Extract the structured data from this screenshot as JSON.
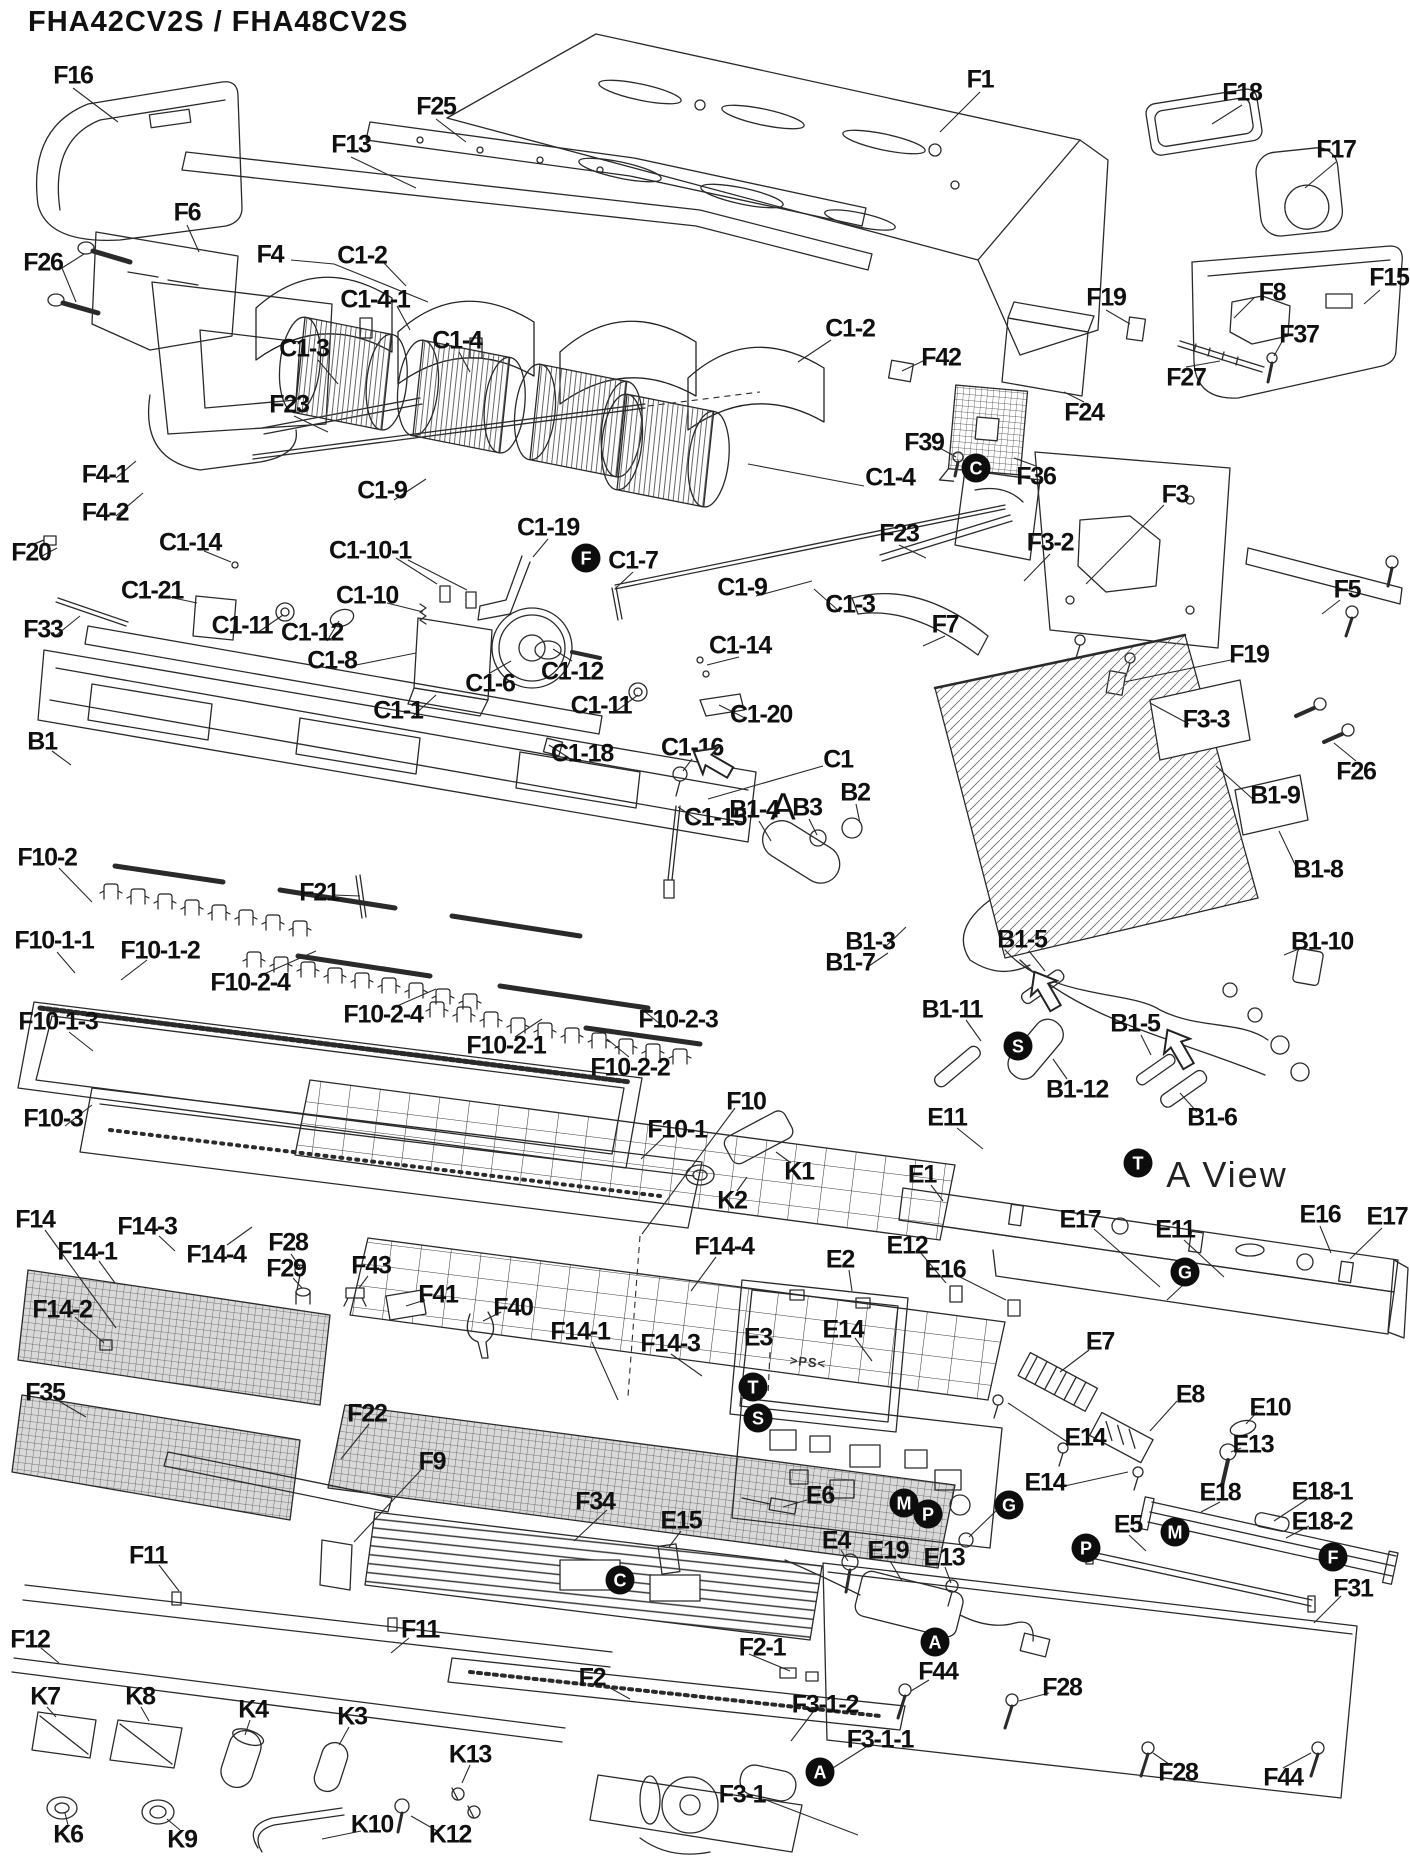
{
  "title": "FHA42CV2S / FHA48CV2S",
  "diagram": {
    "type": "exploded-parts-diagram",
    "view_label": "A View",
    "section_pointer": {
      "t": "A",
      "x": 783,
      "y": 808
    },
    "molding_mark": {
      "t": ">PS<",
      "x": 808,
      "y": 1362
    },
    "ink_color": "#1a1a1a",
    "background_color": "#ffffff",
    "part_labels": [
      {
        "t": "F16",
        "x": 73,
        "y": 76
      },
      {
        "t": "F1",
        "x": 980,
        "y": 80
      },
      {
        "t": "F18",
        "x": 1242,
        "y": 93
      },
      {
        "t": "F17",
        "x": 1336,
        "y": 150
      },
      {
        "t": "F25",
        "x": 436,
        "y": 107
      },
      {
        "t": "F13",
        "x": 351,
        "y": 145
      },
      {
        "t": "F6",
        "x": 187,
        "y": 213
      },
      {
        "t": "F26",
        "x": 43,
        "y": 263
      },
      {
        "t": "F4",
        "x": 270,
        "y": 255
      },
      {
        "t": "C1-2",
        "x": 362,
        "y": 256
      },
      {
        "t": "C1-4-1",
        "x": 375,
        "y": 300
      },
      {
        "t": "F19",
        "x": 1106,
        "y": 298
      },
      {
        "t": "F8",
        "x": 1272,
        "y": 293
      },
      {
        "t": "F15",
        "x": 1389,
        "y": 278
      },
      {
        "t": "F37",
        "x": 1299,
        "y": 335
      },
      {
        "t": "C1-3",
        "x": 304,
        "y": 349
      },
      {
        "t": "C1-4",
        "x": 457,
        "y": 341
      },
      {
        "t": "C1-2",
        "x": 850,
        "y": 329
      },
      {
        "t": "F42",
        "x": 941,
        "y": 358
      },
      {
        "t": "F27",
        "x": 1186,
        "y": 378
      },
      {
        "t": "F24",
        "x": 1084,
        "y": 413
      },
      {
        "t": "F23",
        "x": 289,
        "y": 405
      },
      {
        "t": "F39",
        "x": 924,
        "y": 443
      },
      {
        "t": "F36",
        "x": 1036,
        "y": 477
      },
      {
        "t": "C1-4",
        "x": 890,
        "y": 478
      },
      {
        "t": "F3",
        "x": 1175,
        "y": 495
      },
      {
        "t": "F4-1",
        "x": 105,
        "y": 475
      },
      {
        "t": "F4-2",
        "x": 105,
        "y": 513
      },
      {
        "t": "F20",
        "x": 31,
        "y": 553
      },
      {
        "t": "C1-9",
        "x": 382,
        "y": 491
      },
      {
        "t": "C1-19",
        "x": 548,
        "y": 528
      },
      {
        "t": "C1-14",
        "x": 190,
        "y": 543
      },
      {
        "t": "C1-10-1",
        "x": 370,
        "y": 551
      },
      {
        "t": "C1-7",
        "x": 633,
        "y": 561
      },
      {
        "t": "C1-9",
        "x": 742,
        "y": 588
      },
      {
        "t": "C1-3",
        "x": 850,
        "y": 605
      },
      {
        "t": "F23",
        "x": 899,
        "y": 534
      },
      {
        "t": "F7",
        "x": 945,
        "y": 625
      },
      {
        "t": "F3-2",
        "x": 1050,
        "y": 543
      },
      {
        "t": "F5",
        "x": 1347,
        "y": 590
      },
      {
        "t": "C1-21",
        "x": 152,
        "y": 591
      },
      {
        "t": "C1-10",
        "x": 367,
        "y": 596
      },
      {
        "t": "C1-11",
        "x": 242,
        "y": 626
      },
      {
        "t": "C1-12",
        "x": 312,
        "y": 633
      },
      {
        "t": "F33",
        "x": 43,
        "y": 630
      },
      {
        "t": "C1-8",
        "x": 332,
        "y": 661
      },
      {
        "t": "C1-6",
        "x": 490,
        "y": 684
      },
      {
        "t": "C1-12",
        "x": 572,
        "y": 672
      },
      {
        "t": "C1-14",
        "x": 740,
        "y": 646
      },
      {
        "t": "C1-11",
        "x": 601,
        "y": 706
      },
      {
        "t": "C1-20",
        "x": 761,
        "y": 715
      },
      {
        "t": "F19",
        "x": 1249,
        "y": 655
      },
      {
        "t": "F3-3",
        "x": 1206,
        "y": 720
      },
      {
        "t": "F26",
        "x": 1356,
        "y": 772
      },
      {
        "t": "C1-1",
        "x": 398,
        "y": 711
      },
      {
        "t": "B1",
        "x": 42,
        "y": 742
      },
      {
        "t": "C1-18",
        "x": 582,
        "y": 754
      },
      {
        "t": "C1-16",
        "x": 692,
        "y": 748
      },
      {
        "t": "C1",
        "x": 838,
        "y": 760
      },
      {
        "t": "C1-15",
        "x": 715,
        "y": 818
      },
      {
        "t": "B3",
        "x": 807,
        "y": 808
      },
      {
        "t": "B2",
        "x": 855,
        "y": 793
      },
      {
        "t": "B1-4",
        "x": 754,
        "y": 810
      },
      {
        "t": "B1-9",
        "x": 1275,
        "y": 796
      },
      {
        "t": "B1-8",
        "x": 1318,
        "y": 870
      },
      {
        "t": "B1-3",
        "x": 870,
        "y": 942
      },
      {
        "t": "B1-7",
        "x": 850,
        "y": 963
      },
      {
        "t": "B1-5",
        "x": 1022,
        "y": 940
      },
      {
        "t": "B1-10",
        "x": 1322,
        "y": 942
      },
      {
        "t": "B1-11",
        "x": 952,
        "y": 1010
      },
      {
        "t": "B1-12",
        "x": 1077,
        "y": 1090
      },
      {
        "t": "B1-5",
        "x": 1135,
        "y": 1024
      },
      {
        "t": "B1-6",
        "x": 1212,
        "y": 1118
      },
      {
        "t": "E11",
        "x": 947,
        "y": 1118
      },
      {
        "t": "E1",
        "x": 922,
        "y": 1175
      },
      {
        "t": "E12",
        "x": 907,
        "y": 1246
      },
      {
        "t": "E16",
        "x": 1320,
        "y": 1215
      },
      {
        "t": "E17",
        "x": 1387,
        "y": 1217
      },
      {
        "t": "F10-2",
        "x": 47,
        "y": 858
      },
      {
        "t": "F21",
        "x": 319,
        "y": 893
      },
      {
        "t": "F10-1-1",
        "x": 54,
        "y": 941
      },
      {
        "t": "F10-1-2",
        "x": 160,
        "y": 951
      },
      {
        "t": "F10-2-4",
        "x": 250,
        "y": 983
      },
      {
        "t": "F10-1-3",
        "x": 58,
        "y": 1022
      },
      {
        "t": "F10-2-4",
        "x": 383,
        "y": 1015
      },
      {
        "t": "F10-2-1",
        "x": 506,
        "y": 1046
      },
      {
        "t": "F10-2-3",
        "x": 678,
        "y": 1020
      },
      {
        "t": "F10-2-2",
        "x": 630,
        "y": 1068
      },
      {
        "t": "F10-3",
        "x": 53,
        "y": 1119
      },
      {
        "t": "F10",
        "x": 746,
        "y": 1102
      },
      {
        "t": "F10-1",
        "x": 677,
        "y": 1130
      },
      {
        "t": "K1",
        "x": 799,
        "y": 1172
      },
      {
        "t": "K2",
        "x": 732,
        "y": 1201
      },
      {
        "t": "F14",
        "x": 35,
        "y": 1220
      },
      {
        "t": "F14-3",
        "x": 147,
        "y": 1227
      },
      {
        "t": "F14-1",
        "x": 87,
        "y": 1252
      },
      {
        "t": "F14-4",
        "x": 216,
        "y": 1255
      },
      {
        "t": "F28",
        "x": 288,
        "y": 1243
      },
      {
        "t": "F29",
        "x": 286,
        "y": 1269
      },
      {
        "t": "F43",
        "x": 371,
        "y": 1266
      },
      {
        "t": "F41",
        "x": 438,
        "y": 1295
      },
      {
        "t": "F40",
        "x": 513,
        "y": 1308
      },
      {
        "t": "F14-4",
        "x": 724,
        "y": 1247
      },
      {
        "t": "E2",
        "x": 840,
        "y": 1260
      },
      {
        "t": "E16",
        "x": 945,
        "y": 1270
      },
      {
        "t": "E14",
        "x": 843,
        "y": 1330
      },
      {
        "t": "E3",
        "x": 758,
        "y": 1338
      },
      {
        "t": "E7",
        "x": 1100,
        "y": 1342
      },
      {
        "t": "E17",
        "x": 1080,
        "y": 1220
      },
      {
        "t": "E11",
        "x": 1175,
        "y": 1230
      },
      {
        "t": "E8",
        "x": 1190,
        "y": 1395
      },
      {
        "t": "E10",
        "x": 1270,
        "y": 1408
      },
      {
        "t": "E13",
        "x": 1253,
        "y": 1445
      },
      {
        "t": "E14",
        "x": 1085,
        "y": 1438
      },
      {
        "t": "E14",
        "x": 1045,
        "y": 1483
      },
      {
        "t": "E18",
        "x": 1220,
        "y": 1493
      },
      {
        "t": "E18-1",
        "x": 1322,
        "y": 1492
      },
      {
        "t": "E18-2",
        "x": 1322,
        "y": 1522
      },
      {
        "t": "E5",
        "x": 1128,
        "y": 1525
      },
      {
        "t": "F14-1",
        "x": 580,
        "y": 1332
      },
      {
        "t": "F14-3",
        "x": 670,
        "y": 1344
      },
      {
        "t": "F14-2",
        "x": 62,
        "y": 1310
      },
      {
        "t": "F35",
        "x": 45,
        "y": 1393
      },
      {
        "t": "F22",
        "x": 367,
        "y": 1414
      },
      {
        "t": "F9",
        "x": 432,
        "y": 1462
      },
      {
        "t": "F34",
        "x": 595,
        "y": 1502
      },
      {
        "t": "E15",
        "x": 681,
        "y": 1521
      },
      {
        "t": "E6",
        "x": 820,
        "y": 1496
      },
      {
        "t": "E4",
        "x": 836,
        "y": 1541
      },
      {
        "t": "E19",
        "x": 888,
        "y": 1551
      },
      {
        "t": "E13",
        "x": 944,
        "y": 1558
      },
      {
        "t": "F31",
        "x": 1353,
        "y": 1589
      },
      {
        "t": "F11",
        "x": 148,
        "y": 1556
      },
      {
        "t": "F11",
        "x": 420,
        "y": 1630
      },
      {
        "t": "F12",
        "x": 30,
        "y": 1640
      },
      {
        "t": "F2",
        "x": 592,
        "y": 1678
      },
      {
        "t": "F2-1",
        "x": 762,
        "y": 1648
      },
      {
        "t": "F44",
        "x": 938,
        "y": 1672
      },
      {
        "t": "F28",
        "x": 1062,
        "y": 1688
      },
      {
        "t": "F3-1-2",
        "x": 825,
        "y": 1705
      },
      {
        "t": "F3-1-1",
        "x": 880,
        "y": 1740
      },
      {
        "t": "F3-1",
        "x": 742,
        "y": 1795
      },
      {
        "t": "K7",
        "x": 45,
        "y": 1697
      },
      {
        "t": "K8",
        "x": 140,
        "y": 1697
      },
      {
        "t": "K4",
        "x": 253,
        "y": 1710
      },
      {
        "t": "K3",
        "x": 352,
        "y": 1717
      },
      {
        "t": "K13",
        "x": 470,
        "y": 1755
      },
      {
        "t": "F28",
        "x": 1178,
        "y": 1773
      },
      {
        "t": "F44",
        "x": 1283,
        "y": 1778
      },
      {
        "t": "K10",
        "x": 372,
        "y": 1825
      },
      {
        "t": "K12",
        "x": 450,
        "y": 1835
      },
      {
        "t": "K6",
        "x": 68,
        "y": 1835
      },
      {
        "t": "K9",
        "x": 182,
        "y": 1840
      }
    ],
    "ref_markers": [
      {
        "t": "C",
        "x": 976,
        "y": 468
      },
      {
        "t": "F",
        "x": 586,
        "y": 558
      },
      {
        "t": "S",
        "x": 1018,
        "y": 1046
      },
      {
        "t": "T",
        "x": 1138,
        "y": 1163
      },
      {
        "t": "G",
        "x": 1185,
        "y": 1272
      },
      {
        "t": "T",
        "x": 753,
        "y": 1387
      },
      {
        "t": "S",
        "x": 758,
        "y": 1418
      },
      {
        "t": "M",
        "x": 904,
        "y": 1503
      },
      {
        "t": "P",
        "x": 928,
        "y": 1514
      },
      {
        "t": "G",
        "x": 1009,
        "y": 1505
      },
      {
        "t": "M",
        "x": 1175,
        "y": 1532
      },
      {
        "t": "P",
        "x": 1086,
        "y": 1548
      },
      {
        "t": "F",
        "x": 1333,
        "y": 1557
      },
      {
        "t": "C",
        "x": 620,
        "y": 1580
      },
      {
        "t": "A",
        "x": 935,
        "y": 1642
      },
      {
        "t": "A",
        "x": 820,
        "y": 1772
      }
    ],
    "arrows": [
      {
        "x": 712,
        "y": 762,
        "deg": 30
      },
      {
        "x": 1045,
        "y": 990,
        "deg": 60
      },
      {
        "x": 1178,
        "y": 1048,
        "deg": 60
      }
    ]
  }
}
